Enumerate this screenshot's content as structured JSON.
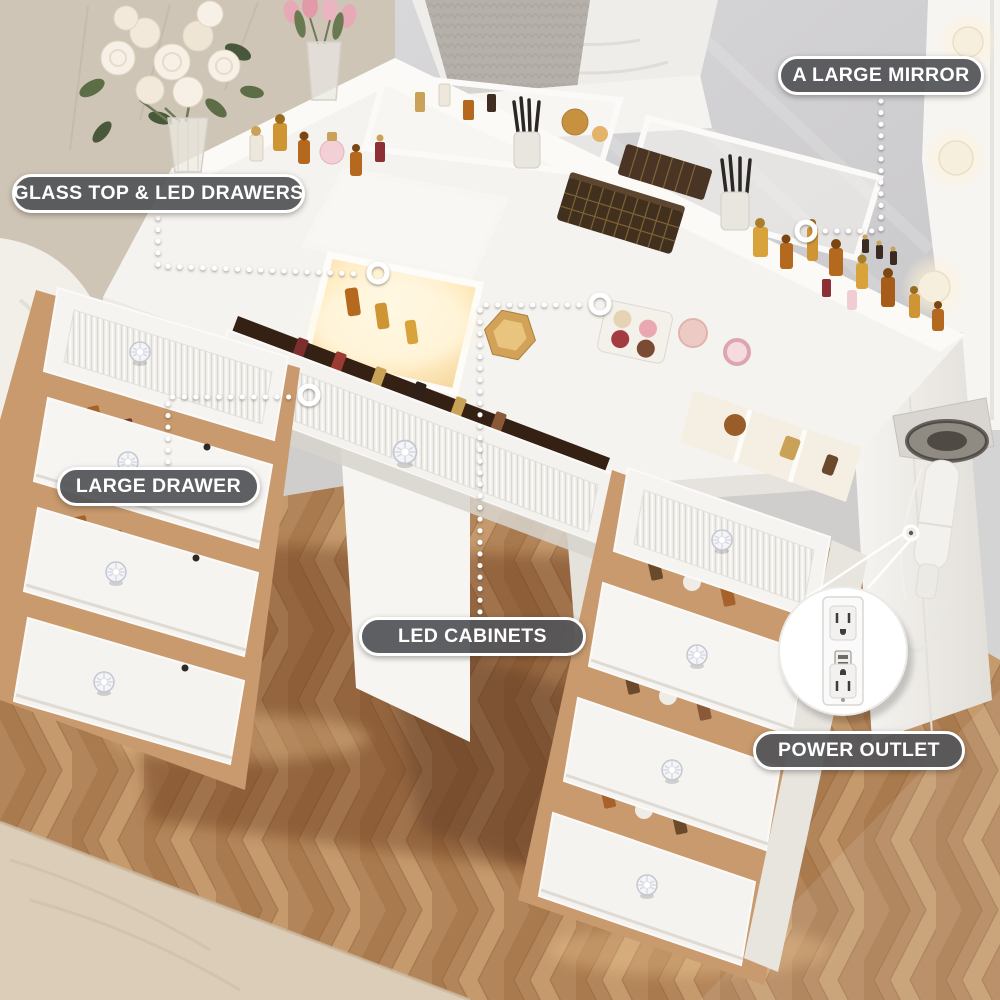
{
  "image": {
    "kind": "product-feature-photo",
    "width": 1000,
    "height": 1000,
    "scene": "White vanity desk with lighted mirror, glass top, open LED drawers and herringbone wood floor"
  },
  "callouts": [
    {
      "id": "large-mirror",
      "label": "A LARGE MIRROR"
    },
    {
      "id": "glass-top-led-drawers",
      "label": "GLASS TOP & LED DRAWERS"
    },
    {
      "id": "large-drawer",
      "label": "LARGE DRAWER"
    },
    {
      "id": "led-cabinets",
      "label": "LED CABINETS"
    },
    {
      "id": "power-outlet",
      "label": "POWER OUTLET"
    }
  ],
  "icons": {
    "ring_marker": "white-circle-ring",
    "leader_line": "white-dotted-line",
    "power_outlet": "duplex-outlet-with-usb",
    "led_bulb": "round-vanity-bulb",
    "crystal_knob": "faceted-crystal-knob",
    "hair_dryer": "hair-dryer-in-holder"
  },
  "colors": {
    "callout_bg": "#55565a",
    "callout_border": "#ffffff",
    "callout_text": "#ffffff",
    "leader_dots": "#ffffff",
    "desk_white": "#f6f4f0",
    "led_glow": "#ffe9c0",
    "floor_light": "#c59a6d",
    "floor_mid": "#b3855a",
    "floor_dark": "#8a5a38",
    "rug_beige": "#dbcdb8",
    "wall_beige": "#cfc5b7",
    "wall_gray": "#d3d2d4",
    "gold": "#cf9434",
    "amber": "#b4691e",
    "blush_pink": "#edcac4"
  }
}
